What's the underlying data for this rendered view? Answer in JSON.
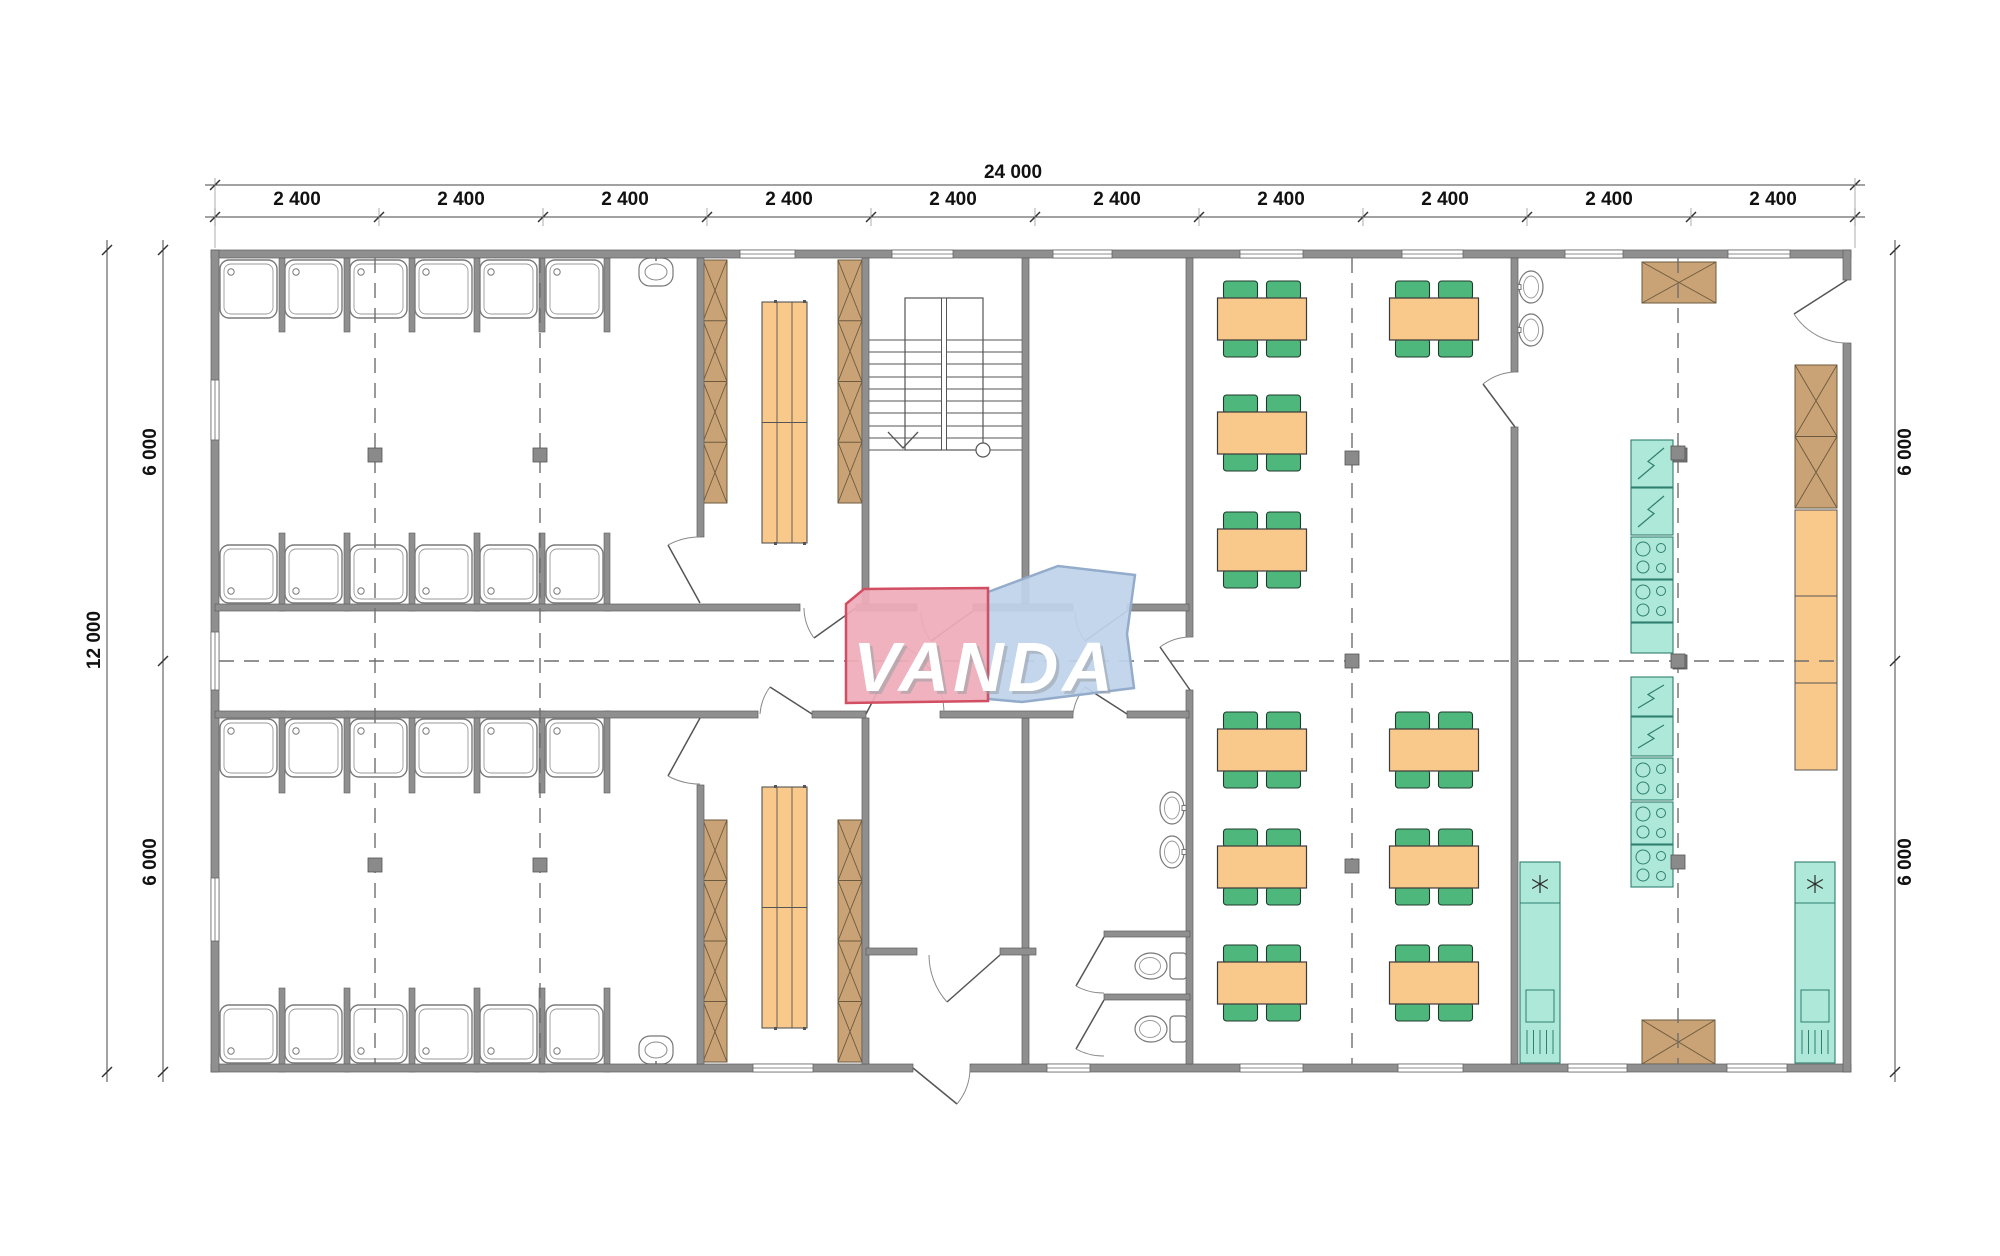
{
  "watermark": {
    "text": "VANDA"
  },
  "dims": {
    "top_total": "24 000",
    "top_segments": [
      "2 400",
      "2 400",
      "2 400",
      "2 400",
      "2 400",
      "2 400",
      "2 400",
      "2 400",
      "2 400",
      "2 400"
    ],
    "left_total": "12 000",
    "left_halves": [
      "6 000",
      "6 000"
    ],
    "right_halves": [
      "6 000",
      "6 000"
    ]
  },
  "colors": {
    "wall": "#8f8f8f",
    "wall_edge": "#5e5e5e",
    "line": "#4d4d4d",
    "thin": "#7a7a7a",
    "axis": "#6f6f6f",
    "locker": "#c9a376",
    "locker_line": "#6d5a3e",
    "bench": "#f9c98c",
    "table": "#f9c88b",
    "table_line": "#3a3a3a",
    "chair": "#4eb87c",
    "chair_line": "#1f3b2c",
    "teal": "#aee8d9",
    "teal_line": "#2f7f6f",
    "logo_pink": "#eeacb9",
    "logo_pink_edge": "#d24f63",
    "logo_blue": "#bed3e9",
    "logo_blue_edge": "#94accb",
    "dim_text": "#111111"
  },
  "grid": {
    "ticks_x": [
      215,
      379,
      543,
      707,
      871,
      1035,
      1199,
      1363,
      1527,
      1691,
      1855
    ],
    "top_line_y": 185,
    "seg_line_y": 217,
    "left_outer_x": 107,
    "left_inner_x": 163,
    "right_x": 1895,
    "ticks_y": [
      250,
      661,
      1072
    ],
    "axes_x": [
      375,
      540,
      1352,
      1678
    ],
    "axis_y": 661,
    "axis_x_range": [
      219,
      1843
    ],
    "axis_y_range": [
      258,
      1064
    ],
    "columns": [
      [
        375,
        455
      ],
      [
        540,
        455
      ],
      [
        375,
        865
      ],
      [
        540,
        865
      ],
      [
        1352,
        458
      ],
      [
        1352,
        661
      ],
      [
        1352,
        866
      ],
      [
        1678,
        453
      ],
      [
        1678,
        661
      ],
      [
        1678,
        862
      ]
    ]
  },
  "fixtures": {
    "shower_stall_xs": [
      220,
      285,
      350,
      415,
      480,
      546
    ],
    "stall_partition_xs": [
      279,
      344,
      409,
      474,
      539,
      604
    ],
    "shower_rows": [
      {
        "y": 260,
        "h": 58,
        "drain": "top",
        "part_y": 258,
        "part_h": 74
      },
      {
        "y": 545,
        "h": 58,
        "drain": "bottom",
        "part_y": 533,
        "part_h": 78
      },
      {
        "y": 719,
        "h": 58,
        "drain": "top",
        "part_y": 711,
        "part_h": 82
      },
      {
        "y": 1005,
        "h": 58,
        "drain": "bottom",
        "part_y": 988,
        "part_h": 84
      }
    ],
    "sinks": [
      {
        "cx": 656,
        "cy": 272,
        "tap": "top"
      },
      {
        "cx": 656,
        "cy": 1050,
        "tap": "bottom"
      }
    ],
    "benches": [
      {
        "x": 762,
        "y": 302,
        "w": 45,
        "h": 241
      },
      {
        "x": 762,
        "y": 787,
        "w": 45,
        "h": 241
      }
    ],
    "lockers": [
      {
        "x": 703,
        "y": 260,
        "w": 24,
        "h": 243,
        "rows": 4
      },
      {
        "x": 838,
        "y": 260,
        "w": 24,
        "h": 243,
        "rows": 4
      },
      {
        "x": 703,
        "y": 820,
        "w": 24,
        "h": 242,
        "rows": 4
      },
      {
        "x": 838,
        "y": 820,
        "w": 24,
        "h": 242,
        "rows": 4
      },
      {
        "x": 1642,
        "y": 262,
        "w": 74,
        "h": 41,
        "rows": 1
      },
      {
        "x": 1795,
        "y": 365,
        "w": 42,
        "h": 143,
        "rows": 2
      },
      {
        "x": 1642,
        "y": 1020,
        "w": 73,
        "h": 44,
        "rows": 1
      }
    ],
    "tables": [
      [
        1262,
        319
      ],
      [
        1262,
        433
      ],
      [
        1262,
        550
      ],
      [
        1434,
        319
      ],
      [
        1262,
        750
      ],
      [
        1262,
        867
      ],
      [
        1262,
        983
      ],
      [
        1434,
        750
      ],
      [
        1434,
        867
      ],
      [
        1434,
        983
      ]
    ],
    "teal_stack": {
      "x": 1631,
      "w": 42,
      "units": [
        {
          "y": 440,
          "h": 47,
          "t": "elec"
        },
        {
          "y": 488,
          "h": 47,
          "t": "elec"
        },
        {
          "y": 537,
          "h": 42,
          "t": "stove"
        },
        {
          "y": 580,
          "h": 42,
          "t": "stove"
        },
        {
          "y": 623,
          "h": 30,
          "t": "plain"
        },
        {
          "y": 677,
          "h": 39,
          "t": "elec"
        },
        {
          "y": 717,
          "h": 39,
          "t": "elec"
        },
        {
          "y": 758,
          "h": 42,
          "t": "stove"
        },
        {
          "y": 802,
          "h": 42,
          "t": "stove"
        },
        {
          "y": 845,
          "h": 42,
          "t": "stove"
        }
      ],
      "connectors": [
        [
          1673,
          448
        ],
        [
          1673,
          655
        ]
      ]
    },
    "counter": {
      "x": 1795,
      "w": 42,
      "sections": [
        {
          "y": 510,
          "h": 86
        },
        {
          "y": 596,
          "h": 87
        },
        {
          "y": 683,
          "h": 87
        }
      ]
    },
    "sink_units": [
      {
        "x": 1520,
        "w": 40,
        "y": 862,
        "h": 201
      },
      {
        "x": 1795,
        "w": 40,
        "y": 862,
        "h": 201
      }
    ],
    "wc_basins": [
      {
        "cx": 1172,
        "cy": 808
      },
      {
        "cx": 1172,
        "cy": 852
      }
    ],
    "kitchen_basins": [
      {
        "cx": 1531,
        "cy": 287
      },
      {
        "cx": 1531,
        "cy": 330
      }
    ],
    "toilets": [
      {
        "cy": 966
      },
      {
        "cy": 1029
      }
    ]
  }
}
